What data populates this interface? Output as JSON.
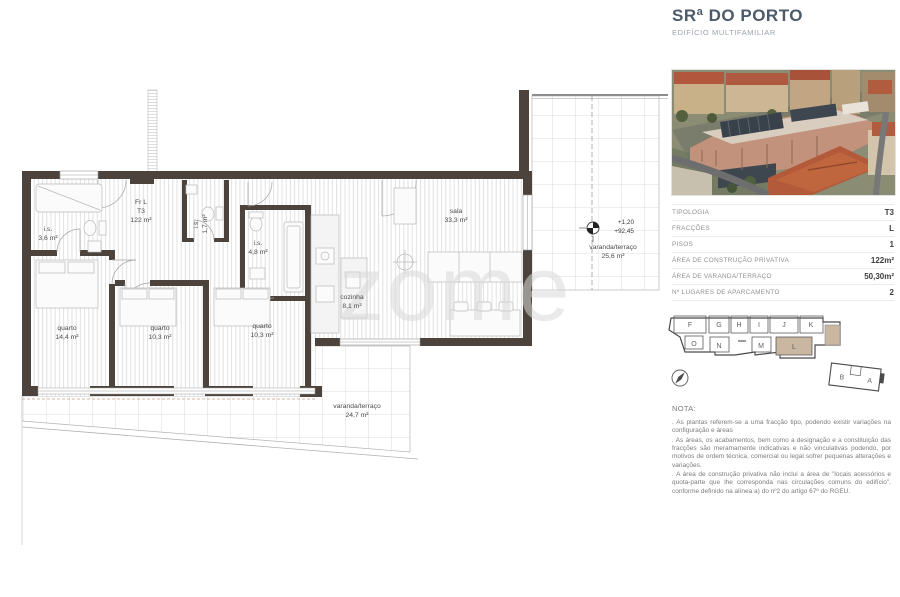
{
  "header": {
    "title": "SRª DO PORTO",
    "subtitle": "EDIFÍCIO MULTIFAMILIAR"
  },
  "details": {
    "rows": [
      {
        "label": "TIPOLOGIA",
        "value": "T3"
      },
      {
        "label": "FRACÇÕES",
        "value": "L"
      },
      {
        "label": "PISOS",
        "value": "1"
      },
      {
        "label": "ÁREA DE CONSTRUÇÃO PRIVATIVA",
        "value": "122m²"
      },
      {
        "label": "ÁREA DE VARANDA/TERRAÇO",
        "value": "50,30m²"
      },
      {
        "label": "Nº LUGARES DE APARCAMENTO",
        "value": "2"
      }
    ]
  },
  "note": {
    "title": "NOTA:",
    "paragraphs": [
      ". As plantas referem-se a uma fracção tipo, podendo existir variações na configuração e áreas",
      ". As áreas, os acabamentos, bem como a designação e a constituição das fracções são meramamente indicativas e não vinculativas podendo, por motivos de ordem técnica, comercial ou legal sofrer pequenas alterações e variações.",
      ". A área de construção privativa não inclui a área de \"locais acessórios e quota-parte que lhe corresponda nas circulações comuns do edifício\", conforme definido na alínea a) do nº2 do artigo 67º do RGEU."
    ]
  },
  "keyplan": {
    "top_units": [
      "F",
      "G",
      "H",
      "I",
      "J",
      "K"
    ],
    "bottom_units": [
      "O",
      "N",
      "M",
      "L"
    ],
    "annex_units": [
      "B",
      "A"
    ],
    "highlight_unit": "L",
    "highlight_color": "#c9b7a1"
  },
  "floorplan": {
    "unit": {
      "line1": "Fr L",
      "line2": "T3",
      "line3": "122 m²"
    },
    "levels": {
      "line1": "+1,20",
      "line2": "+92,45"
    },
    "rooms": [
      {
        "name": "i.s.",
        "area": "3,6 m²"
      },
      {
        "name": "i.s.",
        "area": "1,7 m²"
      },
      {
        "name": "i.s.",
        "area": "4,8 m²"
      },
      {
        "name": "quarto",
        "area": "14,4 m²"
      },
      {
        "name": "quarto",
        "area": "10,3 m²"
      },
      {
        "name": "quarto",
        "area": "10,3 m²"
      },
      {
        "name": "cozinha",
        "area": "8,1 m²"
      },
      {
        "name": "sala",
        "area": "33,3 m²"
      },
      {
        "name": "varanda/terraço",
        "area": "25,6 m²"
      },
      {
        "name": "varanda/terraço",
        "area": "24,7 m²"
      }
    ]
  },
  "watermark": "zome",
  "colors": {
    "wall": "#4c443c",
    "highlight": "#c9b7a1",
    "brand": "#4d5a6a"
  }
}
